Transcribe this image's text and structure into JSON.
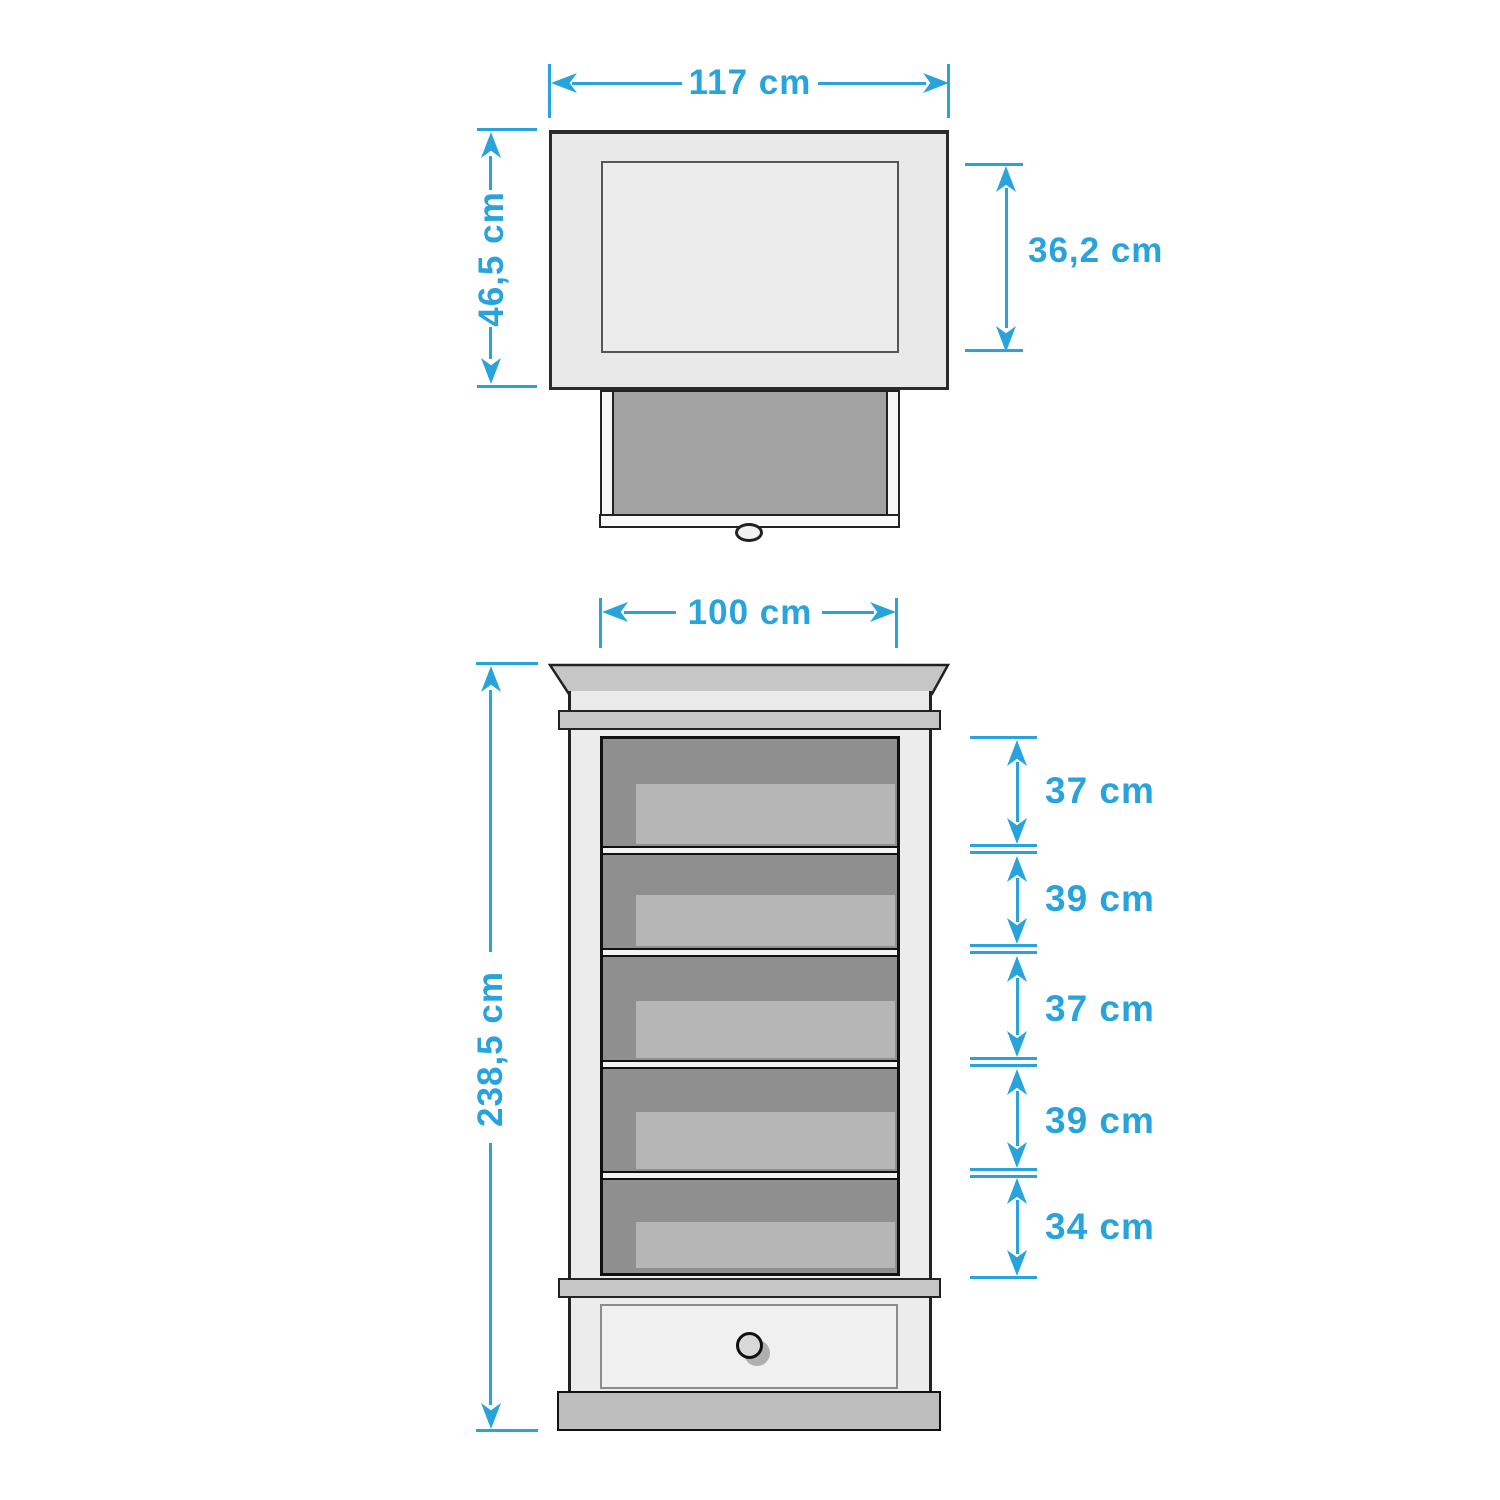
{
  "accent_color": "#29A3DC",
  "top_view": {
    "width_label": "117 cm",
    "depth_label": "46,5 cm",
    "inner_depth_label": "36,2 cm"
  },
  "front_view": {
    "width_label": "100 cm",
    "height_label": "238,5 cm",
    "shelf_gap_labels": [
      "37 cm",
      "39 cm",
      "37 cm",
      "39 cm",
      "34 cm"
    ]
  }
}
